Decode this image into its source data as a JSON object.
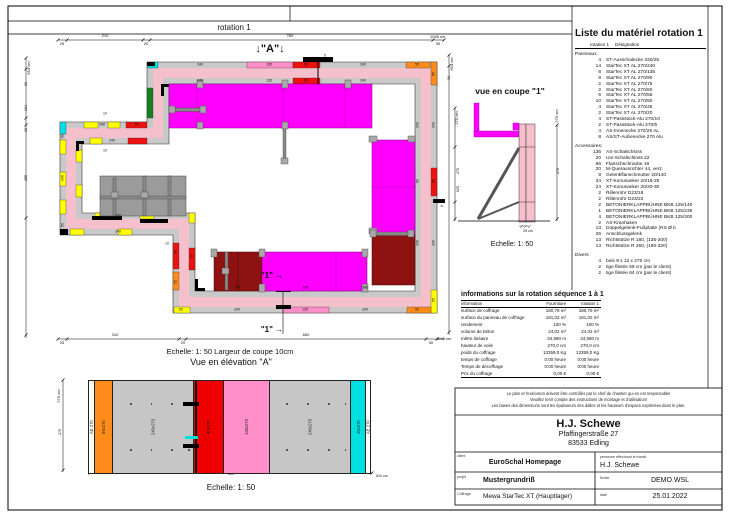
{
  "page": {
    "tab_title": "rotation 1",
    "elevation_marker": "↓\"A\"↓"
  },
  "plan": {
    "scale_note": "Echelle: 1: 50   Largeur de coupe 10cm",
    "labels": [
      {
        "t": "25",
        "x": 62,
        "y": 44,
        "s": 4
      },
      {
        "t": "210",
        "x": 105,
        "y": 36,
        "s": 4
      },
      {
        "t": "20",
        "x": 146,
        "y": 44,
        "s": 4
      },
      {
        "t": "760",
        "x": 290,
        "y": 36,
        "s": 4
      },
      {
        "t": "30",
        "x": 438,
        "y": 44,
        "s": 4
      },
      {
        "t": "1045 cm",
        "x": 430,
        "y": 37,
        "s": 4,
        "a": "start"
      },
      {
        "t": "25",
        "x": 62,
        "y": 343,
        "s": 4
      },
      {
        "t": "310",
        "x": 115,
        "y": 335,
        "s": 4
      },
      {
        "t": "20",
        "x": 183,
        "y": 343,
        "s": 4
      },
      {
        "t": "660",
        "x": 306,
        "y": 335,
        "s": 4
      },
      {
        "t": "30",
        "x": 431,
        "y": 343,
        "s": 4
      },
      {
        "t": "1045 cm",
        "x": 436,
        "y": 339,
        "s": 4,
        "a": "start"
      },
      {
        "t": "654 cm",
        "x": 29,
        "y": 68,
        "s": 4,
        "r": 1
      },
      {
        "t": "30",
        "x": 27,
        "y": 84,
        "s": 3.6,
        "r": 1
      },
      {
        "t": "134",
        "x": 27,
        "y": 108,
        "s": 3.6,
        "r": 1
      },
      {
        "t": "20",
        "x": 27,
        "y": 130,
        "s": 3.6,
        "r": 1
      },
      {
        "t": "255",
        "x": 27,
        "y": 178,
        "s": 3.6,
        "r": 1
      },
      {
        "t": "654 cm",
        "x": 452,
        "y": 64,
        "s": 4,
        "r": 1
      },
      {
        "t": "30",
        "x": 450,
        "y": 78,
        "s": 3.6,
        "r": 1
      },
      {
        "t": "0",
        "x": 443,
        "y": 206,
        "s": 3.6,
        "r": 1
      },
      {
        "t": "45",
        "x": 153,
        "y": 65,
        "s": 3.5
      },
      {
        "t": "240",
        "x": 200,
        "y": 65,
        "s": 3.5
      },
      {
        "t": "135",
        "x": 269,
        "y": 65,
        "s": 3.5
      },
      {
        "t": "50",
        "x": 306,
        "y": 65,
        "s": 3.5
      },
      {
        "t": "240",
        "x": 363,
        "y": 65,
        "s": 3.5
      },
      {
        "t": "55",
        "x": 417,
        "y": 65,
        "s": 3.5
      },
      {
        "t": "5",
        "x": 325,
        "y": 56,
        "s": 3.5
      },
      {
        "t": "240",
        "x": 200,
        "y": 81,
        "s": 3.5
      },
      {
        "t": "135",
        "x": 269,
        "y": 81,
        "s": 3.5
      },
      {
        "t": "50",
        "x": 306,
        "y": 81,
        "s": 3.5
      },
      {
        "t": "240",
        "x": 363,
        "y": 81,
        "s": 3.5
      },
      {
        "t": "50",
        "x": 181,
        "y": 310,
        "s": 3.5
      },
      {
        "t": "240",
        "x": 237,
        "y": 310,
        "s": 3.5
      },
      {
        "t": "135",
        "x": 305,
        "y": 310,
        "s": 3.5
      },
      {
        "t": "240",
        "x": 365,
        "y": 310,
        "s": 3.5
      },
      {
        "t": "55",
        "x": 417,
        "y": 310,
        "s": 3.5
      },
      {
        "t": "240",
        "x": 237,
        "y": 288,
        "s": 3.5
      },
      {
        "t": "135",
        "x": 305,
        "y": 288,
        "s": 3.5
      },
      {
        "t": "240",
        "x": 365,
        "y": 288,
        "s": 3.5
      },
      {
        "t": "55",
        "x": 434,
        "y": 74,
        "s": 3.5,
        "r": 1
      },
      {
        "t": "240",
        "x": 434,
        "y": 125,
        "s": 3.5,
        "r": 1
      },
      {
        "t": "50",
        "x": 434,
        "y": 181,
        "s": 3.5,
        "r": 1
      },
      {
        "t": "240",
        "x": 434,
        "y": 243,
        "s": 3.5,
        "r": 1
      },
      {
        "t": "55",
        "x": 434,
        "y": 300,
        "s": 3.5,
        "r": 1
      },
      {
        "t": "240",
        "x": 418,
        "y": 125,
        "s": 3.5,
        "r": 1
      },
      {
        "t": "50",
        "x": 418,
        "y": 181,
        "s": 3.5,
        "r": 1
      },
      {
        "t": "240",
        "x": 418,
        "y": 243,
        "s": 3.5,
        "r": 1
      },
      {
        "t": "50",
        "x": 63,
        "y": 136,
        "s": 3.5,
        "r": 1
      },
      {
        "t": "240",
        "x": 63,
        "y": 178,
        "s": 3.5,
        "r": 1
      },
      {
        "t": "55",
        "x": 63,
        "y": 225,
        "s": 3.5,
        "r": 1
      },
      {
        "t": "240",
        "x": 102,
        "y": 125,
        "s": 3.5
      },
      {
        "t": "50",
        "x": 137,
        "y": 125,
        "s": 3.5
      },
      {
        "t": "240",
        "x": 112,
        "y": 141,
        "s": 3.5
      },
      {
        "t": "240",
        "x": 118,
        "y": 232,
        "s": 3.5
      },
      {
        "t": "240",
        "x": 118,
        "y": 216,
        "s": 3.5
      },
      {
        "t": "50",
        "x": 176,
        "y": 252,
        "s": 3.5,
        "r": 1
      },
      {
        "t": "55",
        "x": 176,
        "y": 282,
        "s": 3.5,
        "r": 1
      },
      {
        "t": "50",
        "x": 192,
        "y": 256,
        "s": 3.5,
        "r": 1
      },
      {
        "t": "10",
        "x": 105,
        "y": 114,
        "s": 3.5
      },
      {
        "t": "10",
        "x": 105,
        "y": 151,
        "s": 3.5
      },
      {
        "t": "10",
        "x": 167,
        "y": 244,
        "s": 3.5
      },
      {
        "t": "\"1\" →",
        "x": 272,
        "y": 276,
        "s": 8,
        "b": 1
      },
      {
        "t": "\"1\" →",
        "x": 272,
        "y": 330,
        "s": 8,
        "b": 1
      }
    ]
  },
  "section": {
    "title": "vue en coupe \"1\"",
    "scale": "Echelle: 1: 50",
    "labels": [
      {
        "t": "270 cm",
        "x": 457,
        "y": 118,
        "s": 4,
        "r": 1
      },
      {
        "t": "270",
        "x": 459,
        "y": 171,
        "s": 3.6,
        "r": 1
      },
      {
        "t": "629",
        "x": 459,
        "y": 189,
        "s": 3.6,
        "r": 1
      },
      {
        "t": "270 cm",
        "x": 557,
        "y": 116,
        "s": 4,
        "r": 1
      },
      {
        "t": "270",
        "x": 559,
        "y": 171,
        "s": 3.6,
        "r": 1
      },
      {
        "t": "25 cm",
        "x": 528,
        "y": 232,
        "s": 3.6
      }
    ]
  },
  "elevation": {
    "title": "Vue en élévation \"A\"",
    "scale": "Echelle: 1: 50",
    "panels": [
      {
        "label": "AE 270",
        "color": "#ffffff",
        "w": 5
      },
      {
        "label": "55x270",
        "color": "#ff8c1a",
        "w": 19
      },
      {
        "label": "240x270",
        "color": "#c6c6c6",
        "w": 83,
        "dots": true
      },
      {
        "label": "90x270",
        "color": "#ee0000",
        "w": 31
      },
      {
        "label": "135x270",
        "color": "#ff8fc8",
        "w": 47
      },
      {
        "label": "240x270",
        "color": "#c6c6c6",
        "w": 83,
        "dots": true
      },
      {
        "label": "45x270",
        "color": "#00e0e0",
        "w": 16
      },
      {
        "label": "AE 270",
        "color": "#ffffff",
        "w": 5
      }
    ],
    "labels": [
      {
        "t": "270 cm",
        "x": 59,
        "y": 396,
        "s": 4,
        "r": 1
      },
      {
        "t": "270",
        "x": 61,
        "y": 432,
        "s": 3.6,
        "r": 1
      },
      {
        "t": "810",
        "x": 231,
        "y": 475,
        "s": 3.6
      },
      {
        "t": "810 cm",
        "x": 376,
        "y": 477,
        "s": 3.6,
        "a": "start"
      }
    ]
  },
  "material_list": {
    "title": "Liste du matériel  rotation 1",
    "col_qty": "rotation 1",
    "col_name": "Désignation",
    "sections": [
      {
        "name": "Panneaux",
        "items": [
          {
            "qty": "4",
            "name": "ST-Ausschalecke 330/25"
          },
          {
            "qty": "14",
            "name": "StarTec XT AL 270/240"
          },
          {
            "qty": "6",
            "name": "StarTec XT AL 270/135"
          },
          {
            "qty": "8",
            "name": "StarTec XT AL 270/90"
          },
          {
            "qty": "2",
            "name": "StarTec XT AL 270/75"
          },
          {
            "qty": "2",
            "name": "StarTec XT AL 270/60"
          },
          {
            "qty": "6",
            "name": "StarTec XT AL 270/55"
          },
          {
            "qty": "10",
            "name": "StarTec XT AL 270/50"
          },
          {
            "qty": "4",
            "name": "StarTec XT AL 270/45"
          },
          {
            "qty": "2",
            "name": "StarTec XT AL 270/20"
          },
          {
            "qty": "4",
            "name": "ST-Passstück-Alu 270/10"
          },
          {
            "qty": "2",
            "name": "ST-Passstück-Alu 270/5"
          },
          {
            "qty": "4",
            "name": "AS-Innenecke 270/25 AL"
          },
          {
            "qty": "8",
            "name": "AS/ST-Außenecke 270 Alu"
          }
        ]
      },
      {
        "name": "Accessoires:",
        "items": [
          {
            "qty": "136",
            "name": "AS-Schalschloss"
          },
          {
            "qty": "20",
            "name": "Uni-Schalschloss 22"
          },
          {
            "qty": "66",
            "name": "Flanschschraube 18"
          },
          {
            "qty": "20",
            "name": "M-Querausrichter 44, verz."
          },
          {
            "qty": "8",
            "name": "Gelenkflanschmutter 20/140"
          },
          {
            "qty": "34",
            "name": "XT-Konusanker 20/15-25"
          },
          {
            "qty": "24",
            "name": "XT-Konusanker 20/20-30"
          },
          {
            "qty": "2",
            "name": "Rillenrohr D23/18"
          },
          {
            "qty": "2",
            "name": "Rillenrohr D23/23"
          },
          {
            "qty": "2",
            "name": "BETONIERKLAPPBÜHNE BKB 125/140"
          },
          {
            "qty": "1",
            "name": "BETONIERKLAPPBÜHNE BKB 125/235"
          },
          {
            "qty": "4",
            "name": "BETONIERKLAPPBÜHNE BKB 125/300"
          },
          {
            "qty": "2",
            "name": "AS-Kranhaken"
          },
          {
            "qty": "13",
            "name": "Doppelgelenk-Fußplatte (RS Ø b"
          },
          {
            "qty": "26",
            "name": "Anschlussgelenk"
          },
          {
            "qty": "13",
            "name": "Richtstütze R 180, (135-200)"
          },
          {
            "qty": "13",
            "name": "Richtstütze R 250, (180-320)"
          }
        ]
      },
      {
        "name": "Divers",
        "items": [
          {
            "qty": "4",
            "name": "bois 9 x 12 x 270 cm"
          },
          {
            "qty": "2",
            "name": "tige filetée 59 cm (par le client)"
          },
          {
            "qty": "2",
            "name": "tige filetée 64 cm (par le client)"
          }
        ]
      }
    ]
  },
  "info_table": {
    "title": "informations sur la rotation  séquence 1 à 1",
    "headers": [
      "information",
      "Fourniture",
      "rotation 1"
    ],
    "rows": [
      [
        "surface de coffrage",
        "180,79 m²",
        "180,79 m²"
      ],
      [
        "surface du panneau de coffrage",
        "181,02 m²",
        "181,02 m²"
      ],
      [
        "rendement",
        "100 %",
        "100 %"
      ],
      [
        "volume de béton",
        "24,02 m³",
        "24,02 m³"
      ],
      [
        "mètre linéaire",
        "34,580 m",
        "34,580 m"
      ],
      [
        "hauteur de voile",
        "270,0 cm",
        "270,0 cm"
      ],
      [
        "poids du coffrage",
        "13359,0 Kg",
        "13359,0 Kg"
      ],
      [
        "temps de coffrage",
        "0:00 heure",
        "0:00 heure"
      ],
      [
        "Temps de décoffrage",
        "0:00 heure",
        "0:00 heure"
      ],
      [
        "Prix du coffrage",
        "0,00 €",
        "0,00 €"
      ]
    ]
  },
  "title_block": {
    "disclaimer_1": "Le plan et l'exécution doivent être contrôlés par le chef de chantier qui en est responsable!",
    "disclaimer_2": "Veuillez tenir compte des instructions de montage et d'utilisation!",
    "disclaimer_3": "Les bases des dimensions sont les épaisseurs des dalles et les hauteurs d'espace exprimées dans le plan.",
    "company": "H.J. Schewe",
    "address_1": "Pfaffingerstraße 27",
    "address_2": "83533 Edling",
    "client_label": "client",
    "client": "EuroSchal Homepage",
    "worker_label": "personne effectuant le travail",
    "worker": "H.J. Schewe",
    "project_label": "projet",
    "project": "Mustergrundriß",
    "file_label": "fichier",
    "file": "DEMO.WSL",
    "formwork_label": "Coffrage",
    "formwork": "Mewa StarTec XT (Hauptlager)",
    "date_label": "date",
    "date": "25.01.2022"
  }
}
